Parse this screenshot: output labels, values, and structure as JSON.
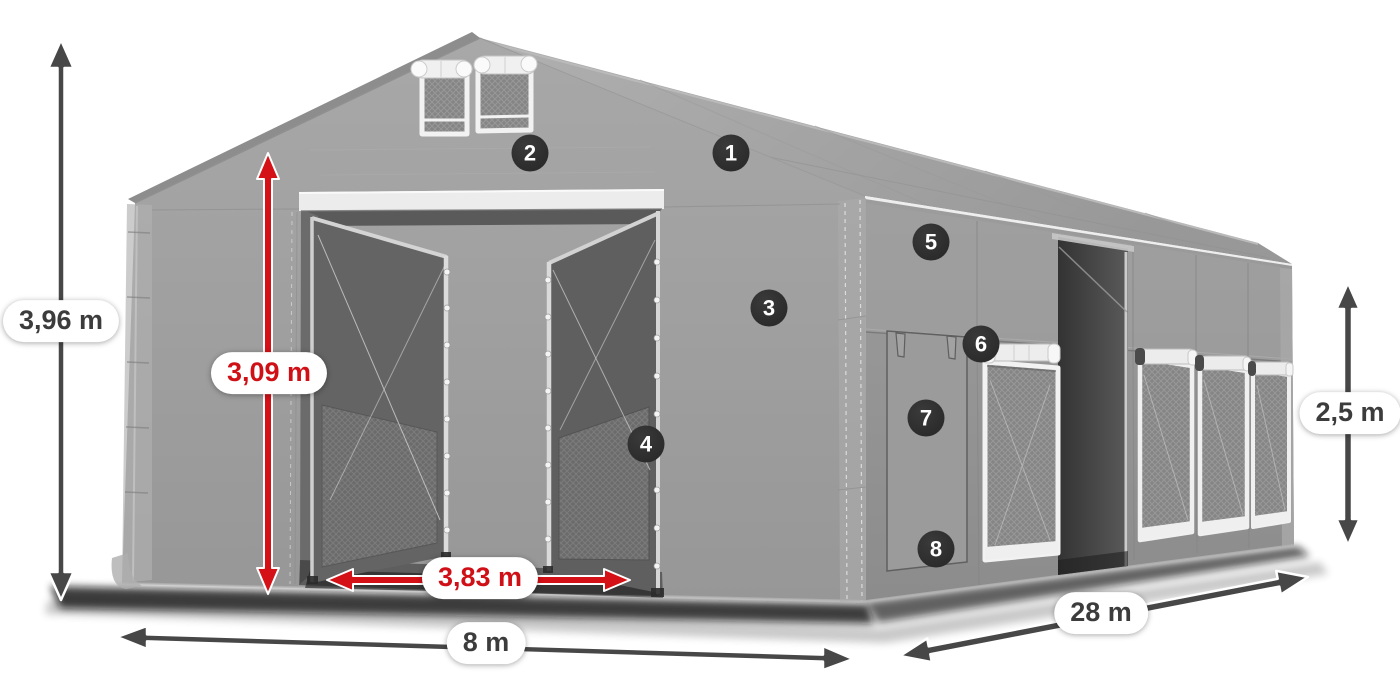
{
  "product": {
    "name": "storage-tent-dimension-diagram",
    "view": "front-left perspective render"
  },
  "dimensions": {
    "total_height": {
      "value": "3,96 m",
      "style": "dark"
    },
    "inner_height": {
      "value": "3,09 m",
      "style": "red"
    },
    "entrance_width": {
      "value": "3,83 m",
      "style": "red"
    },
    "width": {
      "value": "8 m",
      "style": "dark"
    },
    "length": {
      "value": "28 m",
      "style": "dark"
    },
    "side_height": {
      "value": "2,5 m",
      "style": "dark"
    }
  },
  "callouts": [
    "1",
    "2",
    "3",
    "4",
    "5",
    "6",
    "7",
    "8"
  ],
  "colors": {
    "dimension_red": "#d31117",
    "dimension_dark": "#474747",
    "badge_background": "#2d2d2d",
    "tarp_light": "#a9a9a9",
    "tarp_mid": "#999999",
    "tarp_dark": "#8d8d8d",
    "frame_white": "#f0f0f0",
    "interior_dark": "#5a5a5a"
  }
}
